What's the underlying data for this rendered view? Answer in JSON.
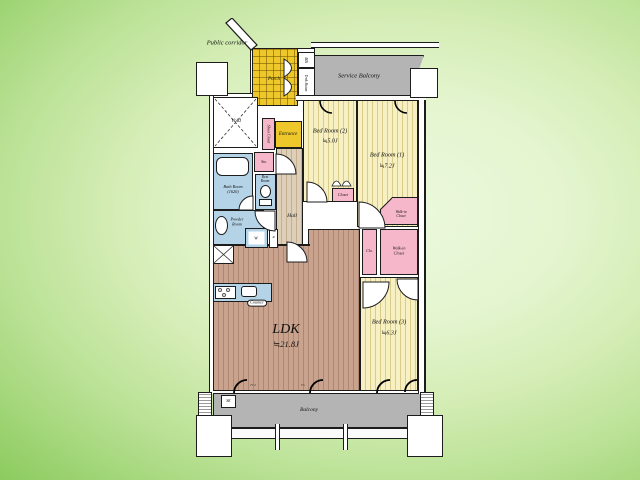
{
  "title": "apartment floor plan",
  "colors": {
    "bg_dark_green": "#7cc452",
    "bg_light_green": "#eaf8da",
    "wall": "#1c1c1c",
    "bedroom_fill": "#f7f0c2",
    "bedroom_stripe": "#d9cc8a",
    "ldk_wood_fill": "#c9a38e",
    "hall_wood_fill": "#ddcfb8",
    "porch_entrance_yellow": "#eec72b",
    "closet_pink": "#f6b7cb",
    "wet_area_blue": "#b5d3e6",
    "balcony_gray": "#b4b4b4"
  },
  "labels": {
    "public_corridor": "Public corridor",
    "porch": "Porch",
    "mb": "MB",
    "trunk_room": "Trnk Room",
    "service_balcony": "Service Balcony",
    "void": "Void",
    "shoes_closet": "Shoes Closet",
    "entrance": "Entrance",
    "storage": "Sto.",
    "bath_room": "Bath Room",
    "bath_size": "(1620)",
    "rest_room_1": "Rest",
    "rest_room_2": "Room",
    "powder_room_1": "Powder",
    "powder_room_2": "Room",
    "washer": "W",
    "fridge": "R",
    "hall": "Hall",
    "counter": "Counter",
    "ldk": "LDK",
    "ldk_area": "≒21.8J",
    "bedroom2": "Bed Room (2)",
    "bedroom2_area": "≒5.0J",
    "bedroom1": "Bed Room (1)",
    "bedroom1_area": "≒7.2J",
    "bedroom3": "Bed Room (3)",
    "bedroom3_area": "≒6.3J",
    "closet": "Closet",
    "clo": "Clo.",
    "walkin_1": "Walk-in",
    "walkin_2": "Closet",
    "sk": "SK",
    "balcony": "Balcony",
    "window_code_1": "FGl",
    "window_code_2": "Fn"
  }
}
